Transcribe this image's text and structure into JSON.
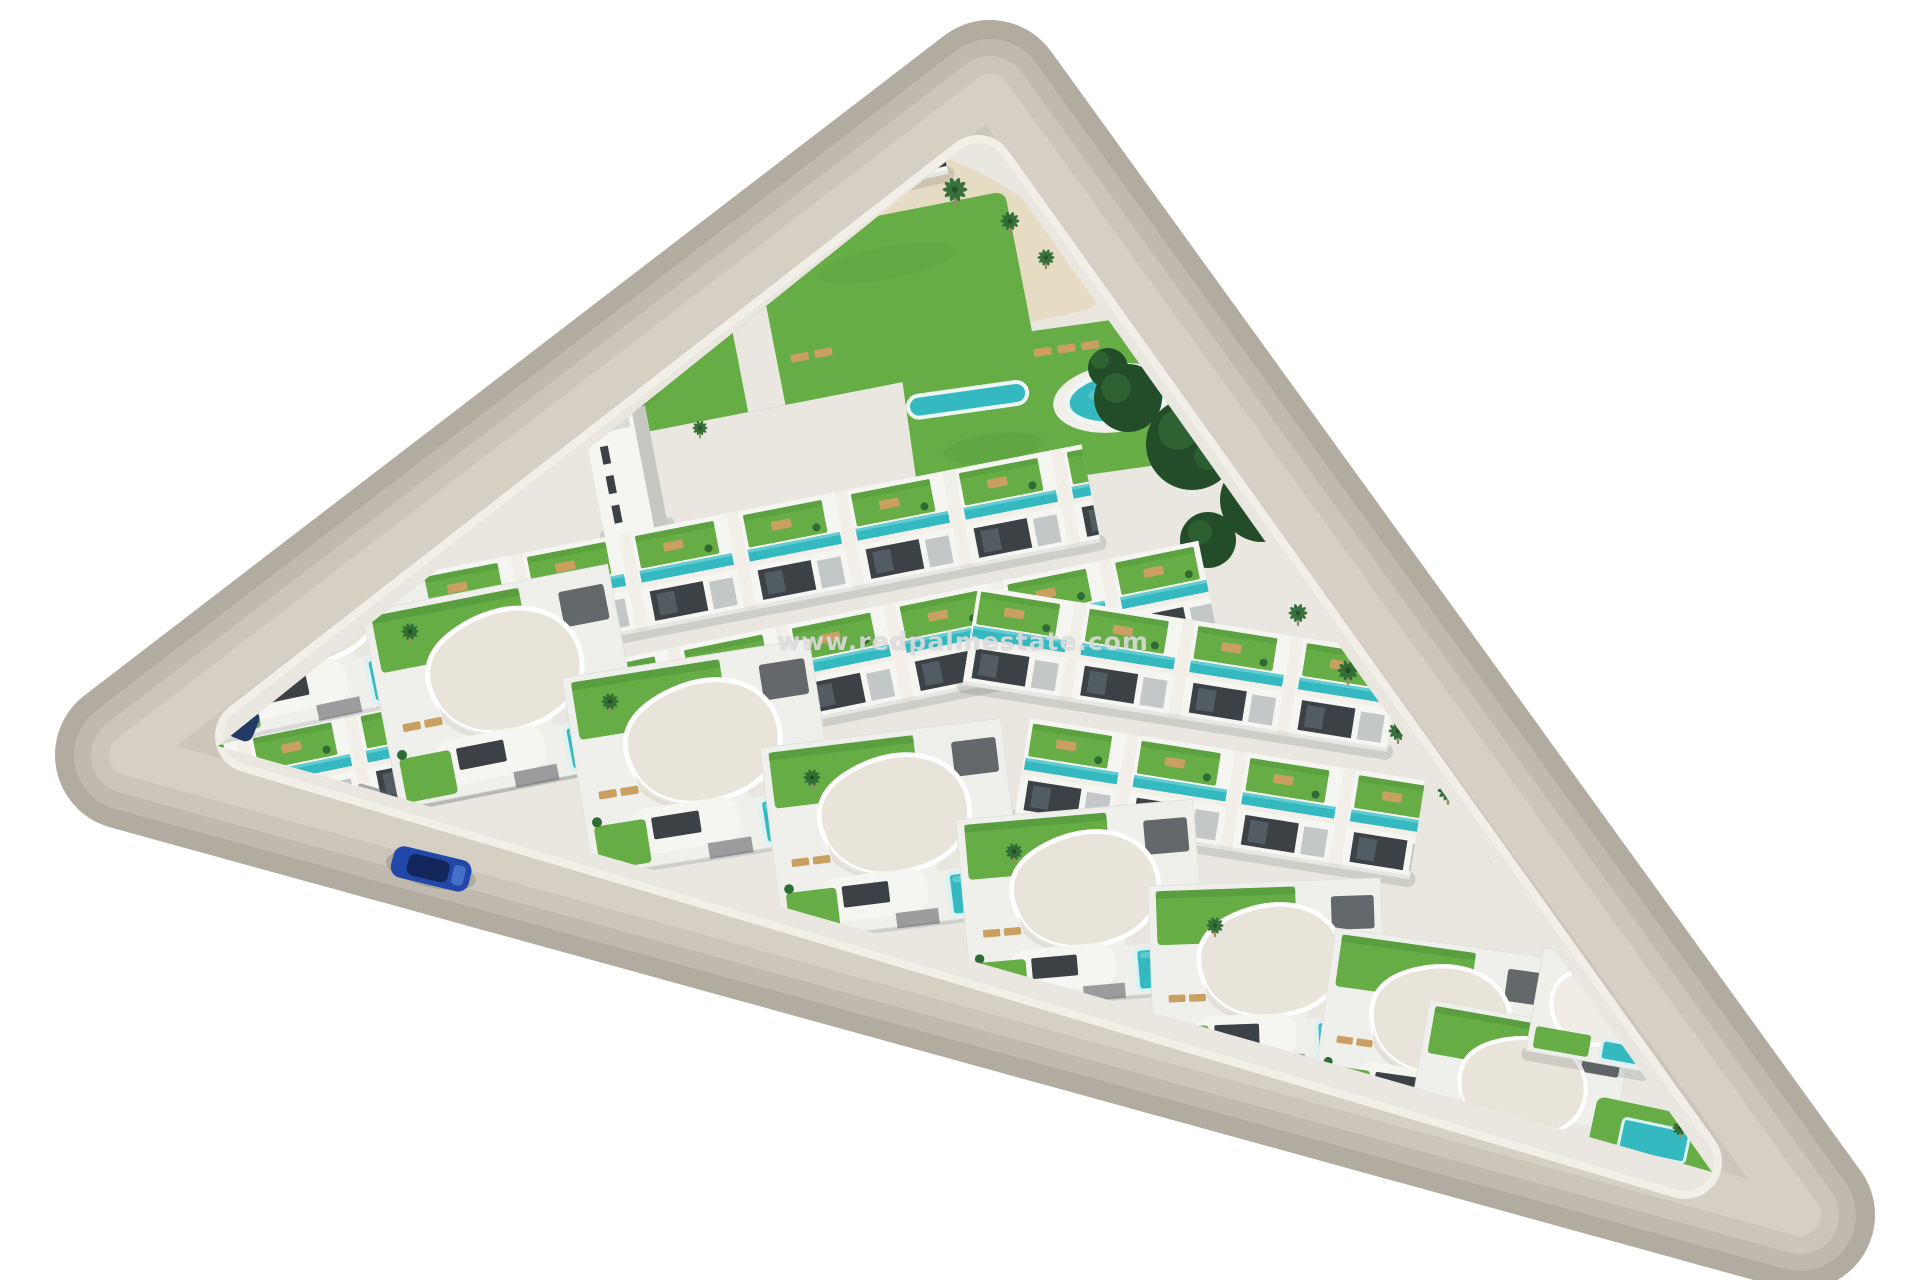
{
  "watermark": {
    "text": "www.redpalmestate.com"
  },
  "scene": {
    "type": "aerial-3d-architectural-render",
    "subject": "Triangular residential development of white terraced homes with roof gardens, communal pools and curved-roof villas, ringed by a perimeter road",
    "colors": {
      "background": "#ffffff",
      "road_outer": "#b2ab9f",
      "road_mid": "#c0b9ad",
      "road_inner": "#ccc6ba",
      "road_center": "#d5cfc4",
      "curb": "#f1efe8",
      "pavement": "#e9e7e0",
      "building": "#f5f5f2",
      "building_shade": "#dbdbd6",
      "building_side": "#c7c7c2",
      "window": "#3b4144",
      "lawn": "#66ad46",
      "lawn_dark": "#4d9238",
      "pool": "#35b9c0",
      "pool_light": "#6fd1d6",
      "sand": "#e6dbc1",
      "tree_dark": "#224d28",
      "tree_light": "#39773c",
      "palm": "#2f6b34",
      "palm_trunk": "#9b8a68",
      "roof_cream": "#e9e4da",
      "wood": "#c9a061",
      "pergola": "#585c5e",
      "car_blue": "#2148a8",
      "car_cabin": "#12265c",
      "suv_navy": "#243a66",
      "watermark": "#dcdcdc",
      "shadow": "rgba(70,75,72,0.16)"
    },
    "landmarks": {
      "perimeter_road": "gray road ring around triangular plot",
      "main_pool": "kidney-shaped communal pool",
      "round_pool": "circular communal pool",
      "lap_pool": "narrow lap pool",
      "sand_plaza": "sandy palm plaza near top edge",
      "townhouse_rows": 7,
      "curved_roof_villas": 9,
      "cars_visible": 2
    }
  }
}
